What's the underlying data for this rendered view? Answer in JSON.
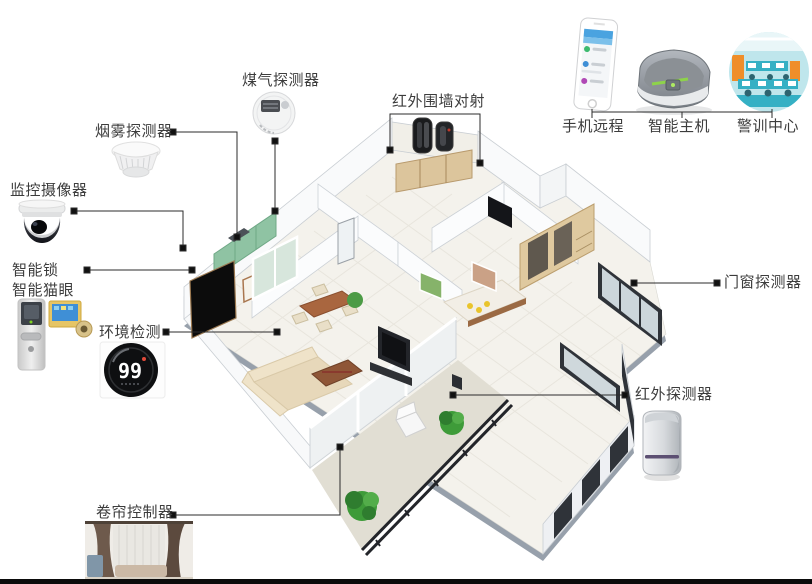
{
  "diagram": {
    "type": "smart-home-security-system-floorplan",
    "labels": {
      "gas_detector": "煤气探测器",
      "smoke_detector": "烟雾探测器",
      "camera": "监控摄像器",
      "smart_lock": "智能锁",
      "smart_peephole": "智能猫眼",
      "env_monitor": "环境检测",
      "curtain_controller": "卷帘控制器",
      "perimeter_beam": "红外围墙对射",
      "door_window_detector": "门窗探测器",
      "pir_detector": "红外探测器"
    },
    "env_monitor_reading": "99",
    "hub_group": {
      "items": [
        {
          "label": "手机远程",
          "icon": "smartphone-icon"
        },
        {
          "label": "智能主机",
          "icon": "smart-hub-icon"
        },
        {
          "label": "警训中心",
          "icon": "alarm-center-icon"
        }
      ]
    },
    "colors": {
      "connector": "#2b2b2b",
      "label_text": "#3c3c3c",
      "kitchen_cabinet_green": "#8fc3a3",
      "wood": "#dcc59c",
      "led_green": "#8ed34a",
      "bottom_bar": "#0b0b0b"
    }
  }
}
